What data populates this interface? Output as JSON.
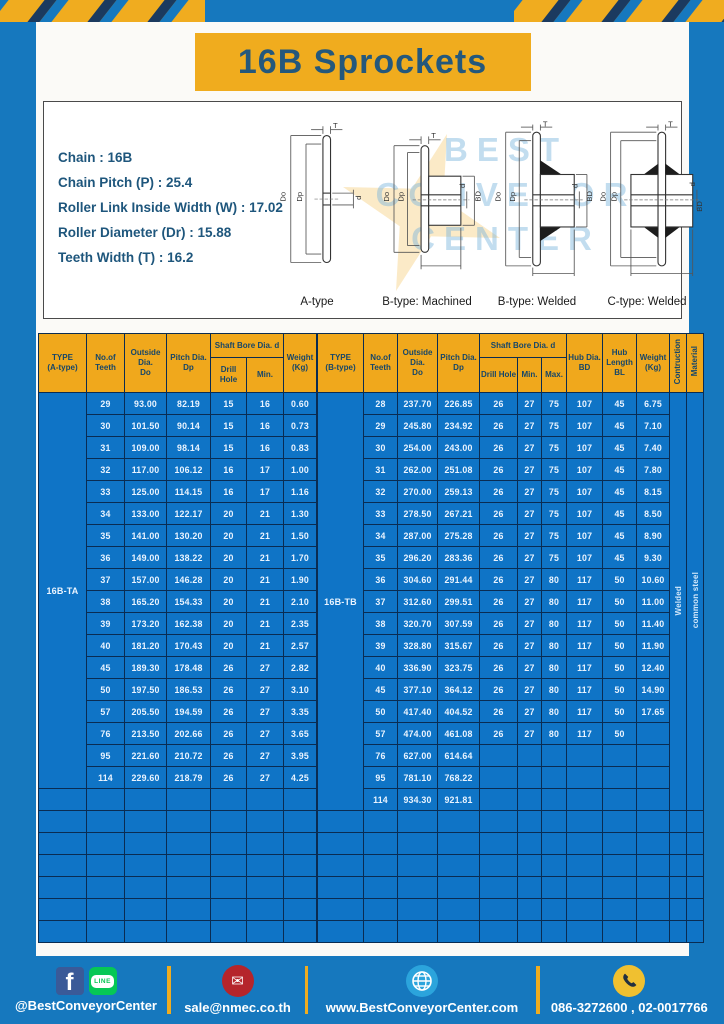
{
  "title": "16B Sprockets",
  "specs": [
    "Chain  :  16B",
    "Chain Pitch (P)  :  25.4",
    "Roller Link Inside Width (W)  :  17.02",
    "Roller Diameter (Dr)  : 15.88",
    "Teeth Width (T)  :  16.2"
  ],
  "watermark": [
    "BEST",
    "CONVEYOR",
    "CENTER"
  ],
  "diagrams": {
    "dims": {
      "t": "T",
      "outside": "Do",
      "pitch": "Dp",
      "bore": "d",
      "hub_dia": "BD",
      "hub_len": "BL"
    },
    "labels": [
      "A-type",
      "B-type: Machined",
      "B-type: Welded",
      "C-type: Welded"
    ]
  },
  "table_a": {
    "headers": {
      "type": "TYPE\n(A-type)",
      "teeth": "No.of\nTeeth",
      "outside": "Outside\nDia.\nDo",
      "pitch": "Pitch Dia.\nDp",
      "shaft_bore": "Shaft Bore Dia. d",
      "drill": "Drill Hole",
      "min": "Min.",
      "weight": "Weight\n(Kg)"
    },
    "type_label": "16B-TA",
    "empty_rows": 7,
    "rows": [
      [
        "29",
        "93.00",
        "82.19",
        "15",
        "16",
        "0.60"
      ],
      [
        "30",
        "101.50",
        "90.14",
        "15",
        "16",
        "0.73"
      ],
      [
        "31",
        "109.00",
        "98.14",
        "15",
        "16",
        "0.83"
      ],
      [
        "32",
        "117.00",
        "106.12",
        "16",
        "17",
        "1.00"
      ],
      [
        "33",
        "125.00",
        "114.15",
        "16",
        "17",
        "1.16"
      ],
      [
        "34",
        "133.00",
        "122.17",
        "20",
        "21",
        "1.30"
      ],
      [
        "35",
        "141.00",
        "130.20",
        "20",
        "21",
        "1.50"
      ],
      [
        "36",
        "149.00",
        "138.22",
        "20",
        "21",
        "1.70"
      ],
      [
        "37",
        "157.00",
        "146.28",
        "20",
        "21",
        "1.90"
      ],
      [
        "38",
        "165.20",
        "154.33",
        "20",
        "21",
        "2.10"
      ],
      [
        "39",
        "173.20",
        "162.38",
        "20",
        "21",
        "2.35"
      ],
      [
        "40",
        "181.20",
        "170.43",
        "20",
        "21",
        "2.57"
      ],
      [
        "45",
        "189.30",
        "178.48",
        "26",
        "27",
        "2.82"
      ],
      [
        "50",
        "197.50",
        "186.53",
        "26",
        "27",
        "3.10"
      ],
      [
        "57",
        "205.50",
        "194.59",
        "26",
        "27",
        "3.35"
      ],
      [
        "76",
        "213.50",
        "202.66",
        "26",
        "27",
        "3.65"
      ],
      [
        "95",
        "221.60",
        "210.72",
        "26",
        "27",
        "3.95"
      ],
      [
        "114",
        "229.60",
        "218.79",
        "26",
        "27",
        "4.25"
      ]
    ]
  },
  "table_b": {
    "headers": {
      "type": "TYPE\n(B-type)",
      "teeth": "No.of\nTeeth",
      "outside": "Outside\nDia.\nDo",
      "pitch": "Pitch Dia.\nDp",
      "shaft_bore": "Shaft Bore Dia. d",
      "drill": "Drill Hole",
      "min": "Min.",
      "max": "Max.",
      "hub_dia": "Hub Dia.\nBD",
      "hub_length": "Hub\nLength\nBL",
      "weight": "Weight\n(Kg)",
      "construction": "Contruction",
      "material": "Material"
    },
    "type_label": "16B-TB",
    "construction_value": "Welded",
    "material_value": "common steel",
    "empty_rows": 6,
    "rows": [
      [
        "28",
        "237.70",
        "226.85",
        "26",
        "27",
        "75",
        "107",
        "45",
        "6.75"
      ],
      [
        "29",
        "245.80",
        "234.92",
        "26",
        "27",
        "75",
        "107",
        "45",
        "7.10"
      ],
      [
        "30",
        "254.00",
        "243.00",
        "26",
        "27",
        "75",
        "107",
        "45",
        "7.40"
      ],
      [
        "31",
        "262.00",
        "251.08",
        "26",
        "27",
        "75",
        "107",
        "45",
        "7.80"
      ],
      [
        "32",
        "270.00",
        "259.13",
        "26",
        "27",
        "75",
        "107",
        "45",
        "8.15"
      ],
      [
        "33",
        "278.50",
        "267.21",
        "26",
        "27",
        "75",
        "107",
        "45",
        "8.50"
      ],
      [
        "34",
        "287.00",
        "275.28",
        "26",
        "27",
        "75",
        "107",
        "45",
        "8.90"
      ],
      [
        "35",
        "296.20",
        "283.36",
        "26",
        "27",
        "75",
        "107",
        "45",
        "9.30"
      ],
      [
        "36",
        "304.60",
        "291.44",
        "26",
        "27",
        "80",
        "117",
        "50",
        "10.60"
      ],
      [
        "37",
        "312.60",
        "299.51",
        "26",
        "27",
        "80",
        "117",
        "50",
        "11.00"
      ],
      [
        "38",
        "320.70",
        "307.59",
        "26",
        "27",
        "80",
        "117",
        "50",
        "11.40"
      ],
      [
        "39",
        "328.80",
        "315.67",
        "26",
        "27",
        "80",
        "117",
        "50",
        "11.90"
      ],
      [
        "40",
        "336.90",
        "323.75",
        "26",
        "27",
        "80",
        "117",
        "50",
        "12.40"
      ],
      [
        "45",
        "377.10",
        "364.12",
        "26",
        "27",
        "80",
        "117",
        "50",
        "14.90"
      ],
      [
        "50",
        "417.40",
        "404.52",
        "26",
        "27",
        "80",
        "117",
        "50",
        "17.65"
      ],
      [
        "57",
        "474.00",
        "461.08",
        "26",
        "27",
        "80",
        "117",
        "50",
        ""
      ],
      [
        "76",
        "627.00",
        "614.64",
        "",
        "",
        "",
        "",
        "",
        ""
      ],
      [
        "95",
        "781.10",
        "768.22",
        "",
        "",
        "",
        "",
        "",
        ""
      ],
      [
        "114",
        "934.30",
        "921.81",
        "",
        "",
        "",
        "",
        "",
        ""
      ]
    ]
  },
  "footer": {
    "items": [
      {
        "icons": [
          "facebook-icon",
          "line-icon"
        ],
        "text": "@BestConveyorCenter"
      },
      {
        "icons": [
          "mail-icon"
        ],
        "text": "sale@nmec.co.th"
      },
      {
        "icons": [
          "globe-icon"
        ],
        "text": "www.BestConveyorCenter.com"
      },
      {
        "icons": [
          "phone-icon"
        ],
        "text": "086-3272600 , 02-0017766"
      }
    ]
  },
  "colors": {
    "background_blue": "#1678BE",
    "cell_blue": "#0F74C6",
    "header_yellow": "#F0A81C",
    "banner_yellow": "#F0AC1E",
    "navy": "#0A2C52",
    "banner_text": "#24587C"
  }
}
